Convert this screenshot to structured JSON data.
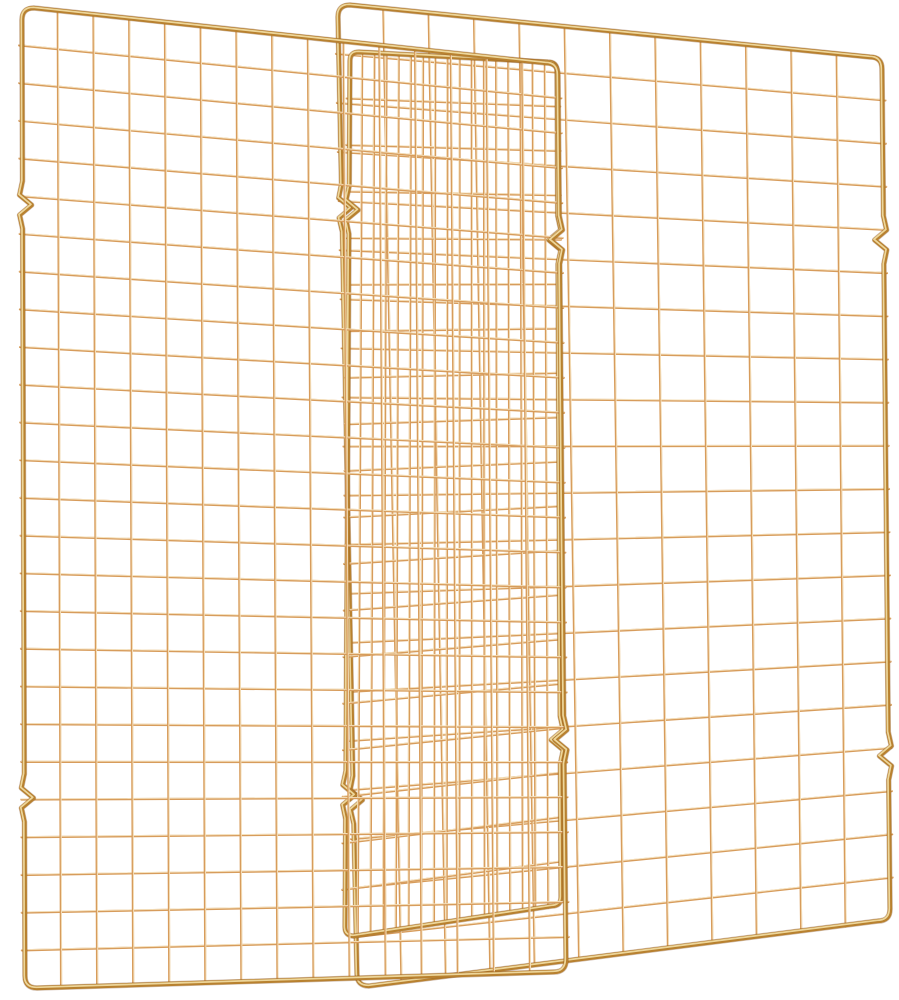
{
  "image": {
    "description": "Product photo of overlapping gold copper-tone wire cooling racks standing upright on a white background",
    "width": 899,
    "height": 1000,
    "background_color": "#ffffff"
  },
  "colors": {
    "wire": "#d79c5c",
    "wire_highlight": "#f8e9c8",
    "frame": "#b8812f",
    "frame_highlight": "#f3dfa6",
    "frame_shadow": "#7c451c"
  },
  "style": {
    "frame_width": 4.4,
    "frame_core_width": 1.7,
    "wire_width": 2.2,
    "wire_core_width": 0.9,
    "corner_radius": 12,
    "notch_half_height": 24,
    "notch_depth": 9,
    "notch_bulge": 3,
    "wire_overhang": 3
  },
  "racks": [
    {
      "id": "cooling-rack-back",
      "label": "back rack (right, face-on)",
      "corners": {
        "tl": [
          338,
          5
        ],
        "tr": [
          882,
          57
        ],
        "br": [
          890,
          921
        ],
        "bl": [
          357,
          986
        ]
      },
      "cols": 11,
      "rows": 19,
      "radius": 12,
      "notches": {
        "left": [
          208,
          800
        ],
        "right": [
          240,
          756
        ]
      }
    },
    {
      "id": "cooling-rack-middle",
      "label": "middle rack (steeply angled, dense)",
      "corners": {
        "tl": [
          350,
          52
        ],
        "tr": [
          557,
          62
        ],
        "br": [
          561,
          906
        ],
        "bl": [
          345,
          936
        ]
      },
      "cols": 16,
      "rows": 18,
      "radius": 9,
      "notches": {
        "left": [
          210,
          795
        ],
        "right": [
          240,
          740
        ]
      }
    },
    {
      "id": "cooling-rack-front",
      "label": "front rack (left, face-on)",
      "corners": {
        "tl": [
          22,
          8
        ],
        "tr": [
          558,
          63
        ],
        "br": [
          566,
          972
        ],
        "bl": [
          25,
          988
        ]
      },
      "cols": 14,
      "rows": 25,
      "radius": 12,
      "notches": {
        "left": [
          205,
          798
        ],
        "right": [
          240,
          740
        ]
      }
    }
  ]
}
